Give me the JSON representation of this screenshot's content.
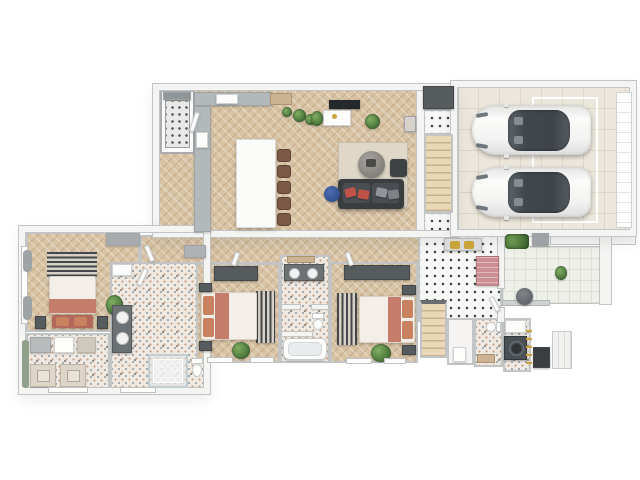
{
  "meta": {
    "title": "3D rendered single-storey house floor plan",
    "view": "top-down isometric render",
    "bedroom_count": 3,
    "bed_count": 3,
    "bathroom_count": 3,
    "garage_car_count": 2,
    "dining_chair_count": 5
  },
  "rooms": {
    "kitchen": {
      "label": "Kitchen and dining area",
      "furniture": [
        "pantry shelving",
        "L-shaped gray counter",
        "cooktop",
        "sink",
        "white dining island",
        "5 brown chairs",
        "plants"
      ]
    },
    "living": {
      "label": "Living room",
      "furniture": [
        "wall TV",
        "white media console",
        "dark sofa with red and gray pillows",
        "round coffee table",
        "side table",
        "blue pouf",
        "beige rug",
        "plants"
      ]
    },
    "stairwell": {
      "label": "Staircase to upper floor",
      "furniture": [
        "wooden stairs",
        "tiled landings",
        "dark closet"
      ]
    },
    "garage": {
      "label": "Double garage",
      "furniture": [
        "white car",
        "white car",
        "sectional garage door",
        "floor marking"
      ]
    },
    "corridor": {
      "label": "Bedroom corridor",
      "furniture": [
        "gray cabinet",
        "doors"
      ]
    },
    "master_bedroom": {
      "label": "Master bedroom",
      "furniture": [
        "double bed with terracotta throw",
        "striped headboard rug",
        "foot bench",
        "nightstands",
        "dresser",
        "plant",
        "curtained windows"
      ]
    },
    "closet_laundry": {
      "label": "Walk-in closet and laundry",
      "furniture": [
        "drawer units",
        "washer",
        "dryer"
      ]
    },
    "master_bath": {
      "label": "Master bathroom",
      "furniture": [
        "double vanity",
        "walk-in shower",
        "toilet",
        "wall cabinet"
      ]
    },
    "bedroom2": {
      "label": "Bedroom 2",
      "furniture": [
        "double bed",
        "dark wardrobe",
        "striped rug",
        "nightstands",
        "plant"
      ]
    },
    "family_bath": {
      "label": "Family bathroom",
      "furniture": [
        "double vanity",
        "toilet",
        "bathtub",
        "wooden shelf"
      ]
    },
    "bedroom3": {
      "label": "Bedroom 3",
      "furniture": [
        "double bed",
        "dark wardrobe",
        "striped rug",
        "nightstands",
        "plant"
      ]
    },
    "mudroom": {
      "label": "Entry mudroom",
      "furniture": [
        "bench with gold cushions",
        "pink runner rug",
        "stairs down",
        "patio door"
      ]
    },
    "utility": {
      "label": "Utility rooms",
      "furniture": [
        "closet",
        "toilet",
        "wooden bench",
        "front-load washer",
        "shelf",
        "gold ladder rack"
      ]
    },
    "patio": {
      "label": "Patio",
      "furniture": [
        "bistro table",
        "hedge",
        "planter",
        "privacy wall",
        "plant",
        "outdoor unit",
        "porch steps"
      ]
    }
  },
  "colors": {
    "wood": "#d8c3a4",
    "wall_white": "#f4f4f3",
    "wall_line": "#c2c5c6",
    "dark_gray": "#565b5e",
    "sofa": "#3a3d40",
    "terracotta": "#c67c6b",
    "pillow_terracotta": "#c8825f",
    "pillow_red": "#c05348",
    "rug_beige": "#dfd8c8",
    "rug_stripe_dark": "#43474a",
    "rug_stripe_light": "#d6d0c6",
    "tile_white": "#f7f7f6",
    "tile_dot": "#454545",
    "mosaic_base": "#efe9e2",
    "garage_floor": "#ece7dc",
    "garage_line": "#ddd6c8",
    "patio_tile": "#eef0e9",
    "patio_line": "#dce1d6",
    "stair_wood": "#ead9b8",
    "stair_line": "#c9b28b",
    "counter": "#b3b8ba",
    "island": "#fbfbfa",
    "car_glass": "#41484d",
    "plant": "#4e7a3e",
    "plant_light": "#7fae63",
    "blue_pouf": "#31508f",
    "gold": "#c9a33c",
    "pink_rug": "#cb8e92",
    "chair_brown": "#7a5a46",
    "bed_white": "#f3eee7",
    "appliance_beige": "#dcd5c8",
    "washer_dark": "#4b5054"
  }
}
